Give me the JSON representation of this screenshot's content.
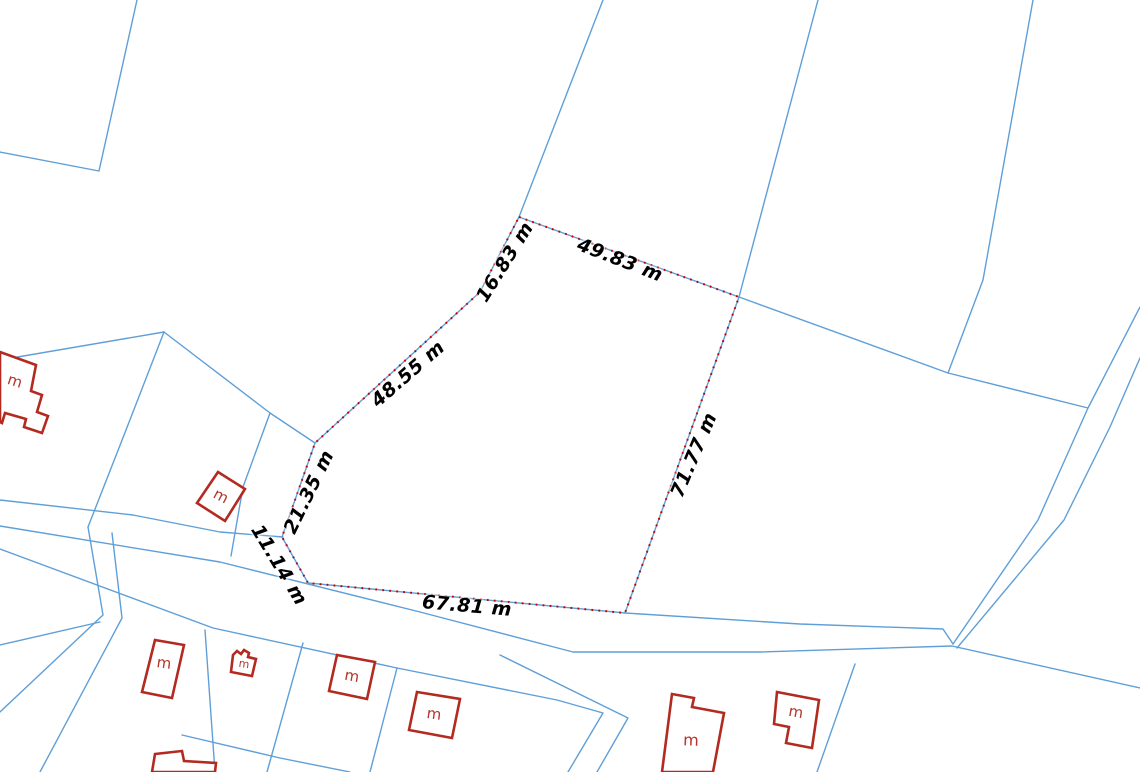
{
  "map": {
    "canvas": {
      "width": 1140,
      "height": 772,
      "background": "#ffffff"
    },
    "colors": {
      "cadastral_line": "#5f9fd8",
      "measure_underlay": "#5f9fd8",
      "measure_dash": "#c40000",
      "building_outline": "#b22a20",
      "building_label": "#b5332a",
      "measure_text": "#000000"
    },
    "measured_parcel": {
      "vertices": [
        [
          519,
          217
        ],
        [
          739,
          297
        ],
        [
          625,
          613
        ],
        [
          308,
          583
        ],
        [
          282,
          537
        ],
        [
          315,
          443
        ],
        [
          480,
          292
        ]
      ]
    },
    "measurements": [
      {
        "text": "49.83 m",
        "x": 620,
        "y": 260,
        "rotation": 21
      },
      {
        "text": "71.77 m",
        "x": 694,
        "y": 455,
        "rotation": -67
      },
      {
        "text": "67.81 m",
        "x": 467,
        "y": 606,
        "rotation": 5
      },
      {
        "text": "11.14 m",
        "x": 279,
        "y": 565,
        "rotation": 59
      },
      {
        "text": "21.35 m",
        "x": 309,
        "y": 492,
        "rotation": -64
      },
      {
        "text": "48.55 m",
        "x": 408,
        "y": 374,
        "rotation": -41
      },
      {
        "text": "16.83 m",
        "x": 505,
        "y": 262,
        "rotation": -58
      }
    ],
    "boundary_lines": [
      [
        [
          137,
          0
        ],
        [
          99,
          171
        ],
        [
          0,
          152
        ]
      ],
      [
        [
          603,
          0
        ],
        [
          519,
          217
        ]
      ],
      [
        [
          818,
          0
        ],
        [
          739,
          297
        ]
      ],
      [
        [
          1033,
          0
        ],
        [
          983,
          280
        ],
        [
          948,
          373
        ]
      ],
      [
        [
          739,
          297
        ],
        [
          948,
          373
        ],
        [
          1088,
          408
        ]
      ],
      [
        [
          1140,
          307
        ],
        [
          1088,
          408
        ],
        [
          1038,
          520
        ],
        [
          953,
          644
        ]
      ],
      [
        [
          1140,
          358
        ],
        [
          1110,
          427
        ],
        [
          1064,
          520
        ],
        [
          957,
          648
        ]
      ],
      [
        [
          0,
          360
        ],
        [
          164,
          332
        ]
      ],
      [
        [
          164,
          332
        ],
        [
          126,
          430
        ],
        [
          88,
          527
        ]
      ],
      [
        [
          164,
          332
        ],
        [
          270,
          413
        ],
        [
          315,
          443
        ]
      ],
      [
        [
          270,
          413
        ],
        [
          243,
          487
        ],
        [
          231,
          556
        ]
      ],
      [
        [
          0,
          500
        ],
        [
          133,
          515
        ],
        [
          220,
          532
        ],
        [
          283,
          537
        ]
      ],
      [
        [
          625,
          613
        ],
        [
          800,
          624
        ],
        [
          943,
          629
        ],
        [
          953,
          644
        ]
      ],
      [
        [
          0,
          526
        ],
        [
          220,
          562
        ],
        [
          420,
          612
        ],
        [
          573,
          652
        ],
        [
          760,
          652
        ],
        [
          952,
          646
        ],
        [
          1140,
          688
        ]
      ],
      [
        [
          0,
          549
        ],
        [
          213,
          628
        ],
        [
          397,
          668
        ],
        [
          557,
          700
        ],
        [
          603,
          713
        ],
        [
          568,
          772
        ]
      ],
      [
        [
          500,
          655
        ],
        [
          628,
          718
        ],
        [
          597,
          772
        ]
      ],
      [
        [
          88,
          527
        ],
        [
          103,
          615
        ],
        [
          0,
          712
        ]
      ],
      [
        [
          112,
          533
        ],
        [
          122,
          618
        ],
        [
          40,
          772
        ]
      ],
      [
        [
          0,
          645
        ],
        [
          100,
          622
        ]
      ],
      [
        [
          205,
          630
        ],
        [
          215,
          772
        ]
      ],
      [
        [
          303,
          643
        ],
        [
          267,
          772
        ]
      ],
      [
        [
          397,
          668
        ],
        [
          370,
          772
        ]
      ],
      [
        [
          855,
          664
        ],
        [
          817,
          772
        ]
      ],
      [
        [
          182,
          735
        ],
        [
          280,
          758
        ],
        [
          350,
          772
        ]
      ]
    ],
    "buildings": [
      {
        "label": "m",
        "label_x": 15,
        "label_y": 381,
        "label_rotation": 18,
        "label_size": 15,
        "outline": [
          [
            0,
            352
          ],
          [
            36,
            365
          ],
          [
            31,
            391
          ],
          [
            42,
            395
          ],
          [
            37,
            412
          ],
          [
            48,
            416
          ],
          [
            42,
            433
          ],
          [
            24,
            427
          ],
          [
            26,
            419
          ],
          [
            5,
            413
          ],
          [
            2,
            423
          ],
          [
            0,
            422
          ]
        ]
      },
      {
        "label": "m",
        "label_x": 221,
        "label_y": 496,
        "label_rotation": 28,
        "label_size": 15,
        "outline": [
          [
            218,
            472
          ],
          [
            245,
            489
          ],
          [
            225,
            521
          ],
          [
            197,
            503
          ]
        ]
      },
      {
        "label": "m",
        "label_x": 164,
        "label_y": 663,
        "label_rotation": 8,
        "label_size": 15,
        "outline": [
          [
            155,
            640
          ],
          [
            184,
            645
          ],
          [
            172,
            698
          ],
          [
            142,
            692
          ]
        ]
      },
      {
        "label": "m",
        "label_x": 244,
        "label_y": 664,
        "label_rotation": 8,
        "label_size": 11,
        "outline": [
          [
            233,
            655
          ],
          [
            237,
            651
          ],
          [
            241,
            654
          ],
          [
            244,
            650
          ],
          [
            249,
            653
          ],
          [
            248,
            657
          ],
          [
            256,
            659
          ],
          [
            252,
            676
          ],
          [
            231,
            672
          ]
        ]
      },
      {
        "label": "m",
        "label_x": 352,
        "label_y": 676,
        "label_rotation": 10,
        "label_size": 15,
        "outline": [
          [
            337,
            655
          ],
          [
            375,
            662
          ],
          [
            367,
            699
          ],
          [
            329,
            691
          ]
        ]
      },
      {
        "label": "m",
        "label_x": 434,
        "label_y": 714,
        "label_rotation": 8,
        "label_size": 15,
        "outline": [
          [
            417,
            692
          ],
          [
            460,
            699
          ],
          [
            452,
            738
          ],
          [
            409,
            730
          ]
        ]
      },
      {
        "label": "",
        "label_x": 0,
        "label_y": 0,
        "label_rotation": 0,
        "label_size": 0,
        "outline": [
          [
            155,
            754
          ],
          [
            182,
            751
          ],
          [
            184,
            761
          ],
          [
            216,
            763
          ],
          [
            215,
            772
          ],
          [
            152,
            772
          ]
        ]
      },
      {
        "label": "m",
        "label_x": 691,
        "label_y": 740,
        "label_rotation": 2,
        "label_size": 16,
        "outline": [
          [
            672,
            694
          ],
          [
            694,
            698
          ],
          [
            692,
            707
          ],
          [
            724,
            713
          ],
          [
            713,
            772
          ],
          [
            662,
            772
          ]
        ]
      },
      {
        "label": "m",
        "label_x": 796,
        "label_y": 712,
        "label_rotation": 10,
        "label_size": 15,
        "outline": [
          [
            777,
            692
          ],
          [
            819,
            700
          ],
          [
            812,
            748
          ],
          [
            786,
            743
          ],
          [
            789,
            727
          ],
          [
            774,
            724
          ]
        ]
      }
    ]
  }
}
